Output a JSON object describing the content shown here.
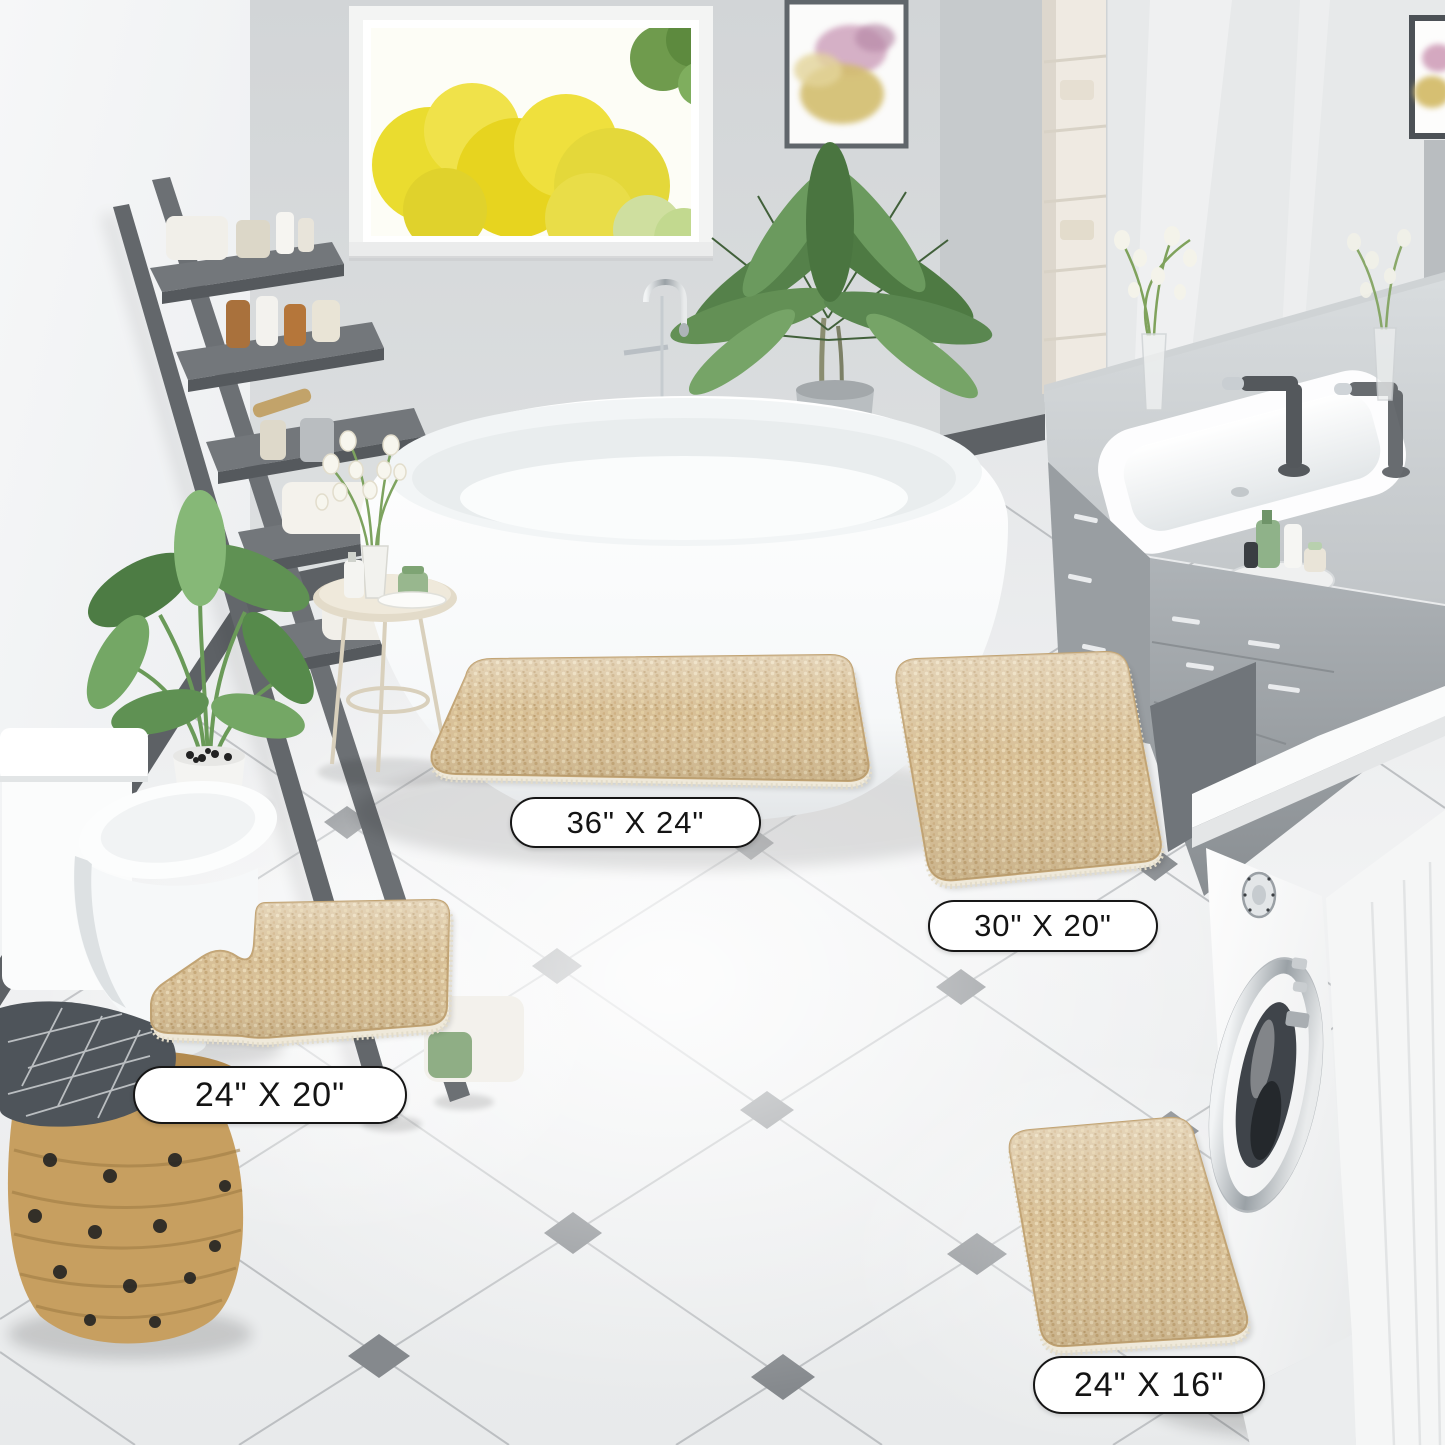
{
  "image": {
    "kind": "product-lifestyle-photo",
    "scene": "bathroom with four-piece beige chenille bath rug set"
  },
  "palette": {
    "rug_beige": "#d8c097",
    "rug_edge": "#c2a474",
    "wall_gray": "#d6d9db",
    "left_wall": "#f3f4f5",
    "floor": "#eff1f2",
    "tile_accent": "#85898d",
    "baseboard": "#5d6165",
    "label_bg": "#ffffff",
    "label_border": "#161616",
    "label_text": "#141414"
  },
  "rugs": {
    "items": [
      {
        "id": "large",
        "size_label": "36\" X 24\""
      },
      {
        "id": "runner",
        "size_label": "30\" X 20\""
      },
      {
        "id": "contour",
        "size_label": "24\" X 20\""
      },
      {
        "id": "small",
        "size_label": "24\" X 16\""
      }
    ]
  }
}
